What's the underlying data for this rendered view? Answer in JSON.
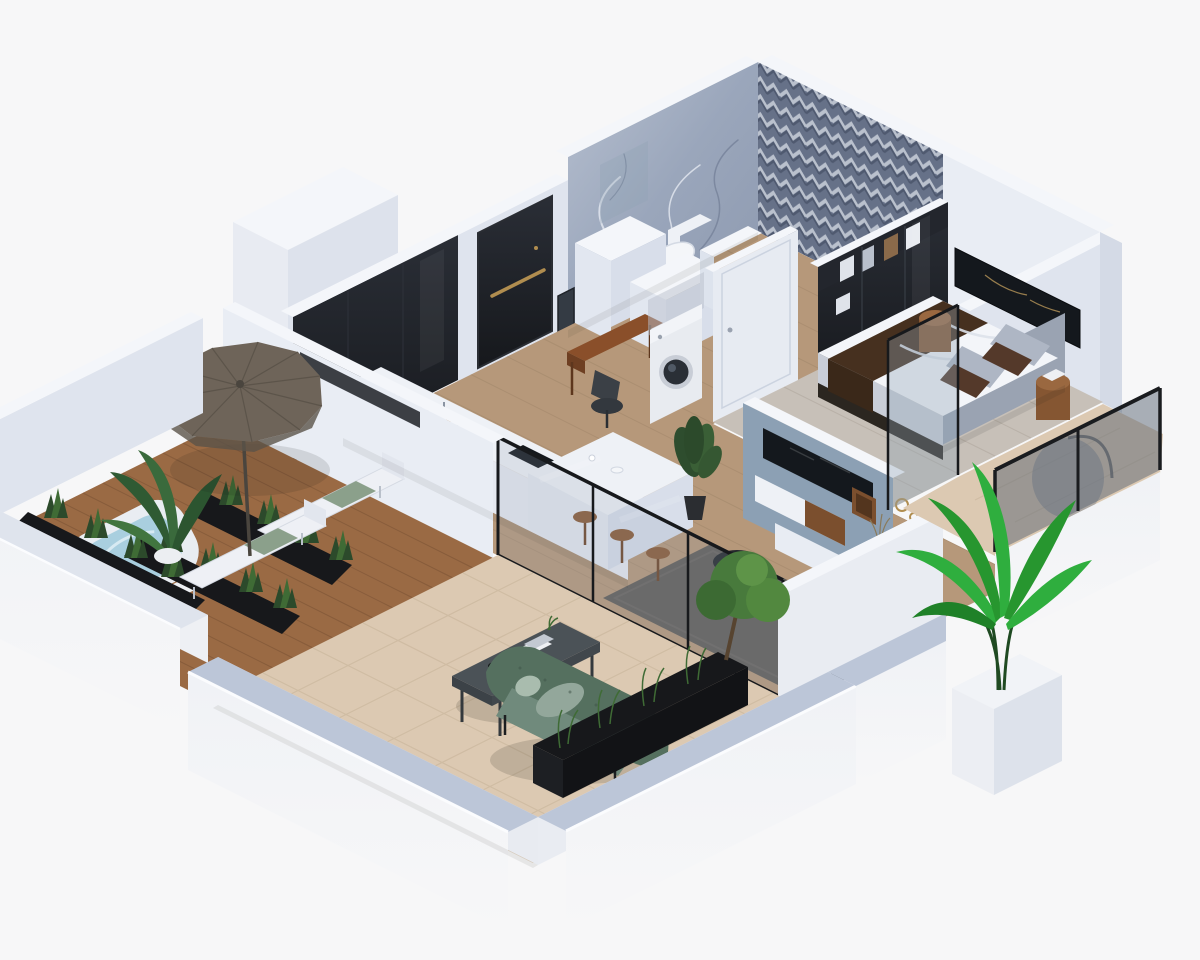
{
  "scene": {
    "title": "isometric-apartment-cutaway-render",
    "style": "3d-architectural-visualization",
    "rooms": [
      {
        "name": "bathroom",
        "features": [
          "marble feature wall",
          "chevron tile feature wall",
          "toilet",
          "white partition walls",
          "mirror"
        ]
      },
      {
        "name": "entry-hall",
        "features": [
          "black entry door with brass handle",
          "black gloss wardrobe",
          "white display ledge with red decor",
          "wood plank floor"
        ]
      },
      {
        "name": "kitchen",
        "features": [
          "white counter with black cooktop",
          "white breakfast island",
          "three wooden bar stools",
          "coffee cups"
        ]
      },
      {
        "name": "study-nook",
        "features": [
          "walnut desk",
          "dark office chair",
          "washing machine in niche"
        ]
      },
      {
        "name": "living-room",
        "features": [
          "blue-gray media wall with recessed TV",
          "floating white and walnut console",
          "dark gray rug",
          "round black side table",
          "potted plant",
          "black framed sliding glass doors"
        ]
      },
      {
        "name": "bedroom",
        "features": [
          "double bed with white duvet and brown runner",
          "gray and brown pillows",
          "gray headboard",
          "dark glass wardrobe with clothes",
          "dark wall art panel",
          "round wooden nightstands",
          "glass balustrade balcony",
          "hanging chair"
        ]
      },
      {
        "name": "terrace",
        "features": [
          "wooden deck",
          "white hot tub with blue water",
          "taupe patio umbrella",
          "two white sun loungers with green towels",
          "black planters with shrubs",
          "banana plant"
        ]
      },
      {
        "name": "outdoor-lounge",
        "features": [
          "beige travertine tile floor",
          "green tufted outdoor sofa",
          "graphite coffee table with books",
          "long black planter with grasses and small tree",
          "bright palm in white planter",
          "white parapet walls"
        ]
      }
    ]
  },
  "palette": {
    "bg": "#f7f7f8",
    "wallTop": "#f4f6fa",
    "wallLight": "#e9edf4",
    "wallShade": "#dfe4ee",
    "wallDark": "#c9d1e0",
    "plinthTop": "#bcc6d8",
    "outerFace": "#f0f2f6",
    "marble": "#9aa6bb",
    "marbleVein": "#e6eaf2",
    "chevronBg": "#6d7890",
    "chevronLight": "#ccd3df",
    "blackGloss": "#16181c",
    "brass": "#b08d4f",
    "doorWhite": "#e7ebf2",
    "woodFloor": "#b6987a",
    "woodLine": "#a0866a",
    "bedroomFloor": "#c7c0b8",
    "deck": "#9a6a44",
    "deckLine": "#7c5435",
    "tile": "#dcc9b2",
    "tileLine": "#cbb79e",
    "rug": "#615d58",
    "mediaWall": "#8ca0b4",
    "tvBlack": "#14181d",
    "walnut": "#7b4f2e",
    "consoleWhite": "#eef1f6",
    "bedWhite": "#f3f5f9",
    "bedRunner": "#46301f",
    "pillowGray": "#aeb6c4",
    "pillowBrown": "#54392a",
    "headboard": "#9aa3b2",
    "nightstand": "#855632",
    "sofaGreen": "#55705f",
    "sofaSeat": "#708a7c",
    "sofaCushion": "#93a79b",
    "tableGraphite": "#4b5257",
    "umbrella": "#6e6459",
    "umbrellaDark": "#5a5248",
    "hotTubWater": "#a9cfdf",
    "pureWhite": "#eef0f5",
    "planterBlack": "#17181b",
    "plantDark": "#2c4a2b",
    "plantMid": "#3f6b35",
    "plantBright": "#2fae3e",
    "stoolBrown": "#8a5a36",
    "deskWood": "#8a4f2a",
    "glassTint": "#8fa2b4",
    "appliance": "#e8ebf0",
    "red": "#b33a2c"
  }
}
